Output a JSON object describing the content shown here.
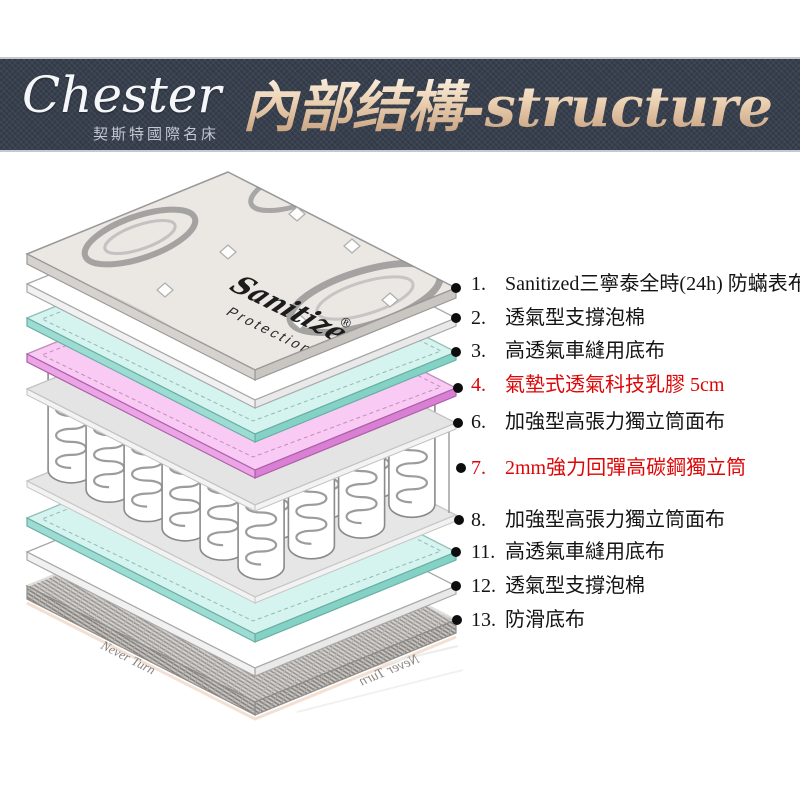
{
  "header": {
    "brand": "Chester",
    "brand_subtitle": "契斯特國際名床",
    "title": "內部结構-structure"
  },
  "labels": {
    "items": [
      {
        "num": "1.",
        "text": "Sanitized三寧泰全時(24h) 防蟎表布",
        "highlight": false
      },
      {
        "num": "2.",
        "text": "透氣型支撐泡棉",
        "highlight": false
      },
      {
        "num": "3.",
        "text": "高透氣車縫用底布",
        "highlight": false
      },
      {
        "num": "4.",
        "text": "氣墊式透氣科技乳膠 5cm",
        "highlight": true
      },
      {
        "num": "6.",
        "text": "加強型高張力獨立筒面布",
        "highlight": false
      },
      {
        "num": "7.",
        "text": "2mm強力回彈高碳鋼獨立筒",
        "highlight": true
      },
      {
        "num": "8.",
        "text": "加強型高張力獨立筒面布",
        "highlight": false
      },
      {
        "num": "11.",
        "text": "高透氣車縫用底布",
        "highlight": false
      },
      {
        "num": "12.",
        "text": "透氣型支撐泡棉",
        "highlight": false
      },
      {
        "num": "13.",
        "text": "防滑底布",
        "highlight": false
      }
    ]
  },
  "fabric_logo": {
    "brand": "Sanitized",
    "reg": "®",
    "type": "Protection"
  },
  "bottom_fabric_text": "Never Turn",
  "colors": {
    "banner_bg": "#333b49",
    "title_gold_light": "#fbf1e2",
    "title_gold_dark": "#c59e7c",
    "highlight_red": "#dd0606",
    "cyan_top": "#d5f4ef",
    "cyan_side": "#84d2c6",
    "pink_top": "#f9cbf4",
    "pink_side": "#d97fd4"
  }
}
